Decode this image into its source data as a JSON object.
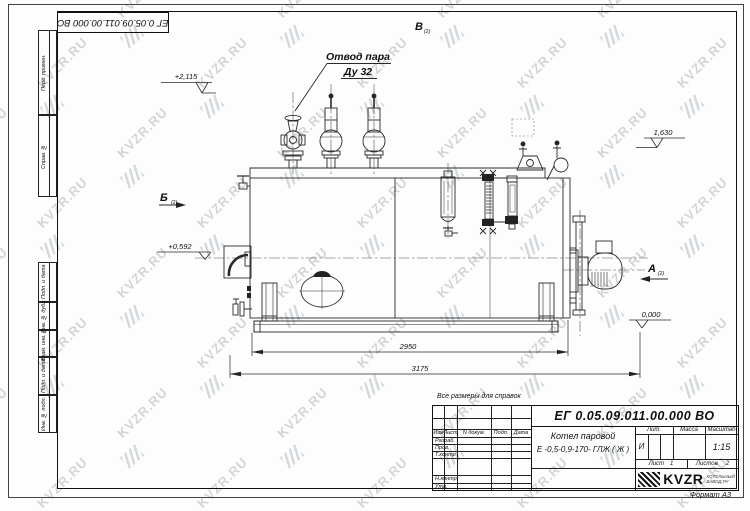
{
  "watermark": {
    "text": "KVZR.RU"
  },
  "stamp_top": {
    "doc_number": "ЕГ 0.05.09.011.00.000  ВО"
  },
  "drawing": {
    "callout": {
      "line1": "Отвод пара",
      "line2": "Ду 32"
    },
    "views": {
      "top": {
        "letter": "В",
        "ref": "(2)"
      },
      "left": {
        "letter": "Б",
        "ref": "(2)"
      },
      "right": {
        "letter": "А",
        "ref": "(2)"
      }
    },
    "elevations": {
      "valve_top": "+2,115",
      "shell_top": "1,630",
      "axis": "+0,592",
      "ground": "0,000"
    },
    "dimensions": {
      "shell_length": "2950",
      "overall_length": "3175"
    }
  },
  "notes": {
    "reference_note": "Все размеры для справок",
    "format_label": "Формат А3"
  },
  "title_block": {
    "doc_number": "ЕГ 0.05.09.011.00.000  ВО",
    "product_line1": "Котел паровой",
    "product_line2": "Е -0,5-0,9-170- ГЛЖ ( Ж )",
    "table_headers": {
      "izm": "Изм",
      "list": "Лист",
      "doc": "N докум.",
      "sign": "Подп.",
      "date": "Дата"
    },
    "sig_rows": {
      "developed": "Разраб.",
      "checked": "Пров.",
      "tcontrol": "Т.контр",
      "ncontrol": "Н.контр",
      "approved": "Утв."
    },
    "lit": {
      "header": "Лит.",
      "value": "И"
    },
    "mass": {
      "header": "Масса"
    },
    "scale": {
      "header": "Масштаб",
      "value": "1:15"
    },
    "sheet": {
      "label": "Лист",
      "value": "1"
    },
    "sheets": {
      "label": "Листов",
      "value": "2"
    },
    "logo": {
      "text": "KVZR",
      "sub1": "КОТЕЛЬНЫЙ",
      "sub2": "ЗАВОД.РУ"
    }
  },
  "side_strip": {
    "cells": [
      {
        "label": "Перв. примен."
      },
      {
        "label": "Справ. №"
      },
      {
        "label": "Подп. и дата"
      },
      {
        "label": "Инв. № дубл."
      },
      {
        "label": "Взам. инв. №"
      },
      {
        "label": "Подп. и дата"
      },
      {
        "label": "Инв. № подл."
      }
    ]
  }
}
